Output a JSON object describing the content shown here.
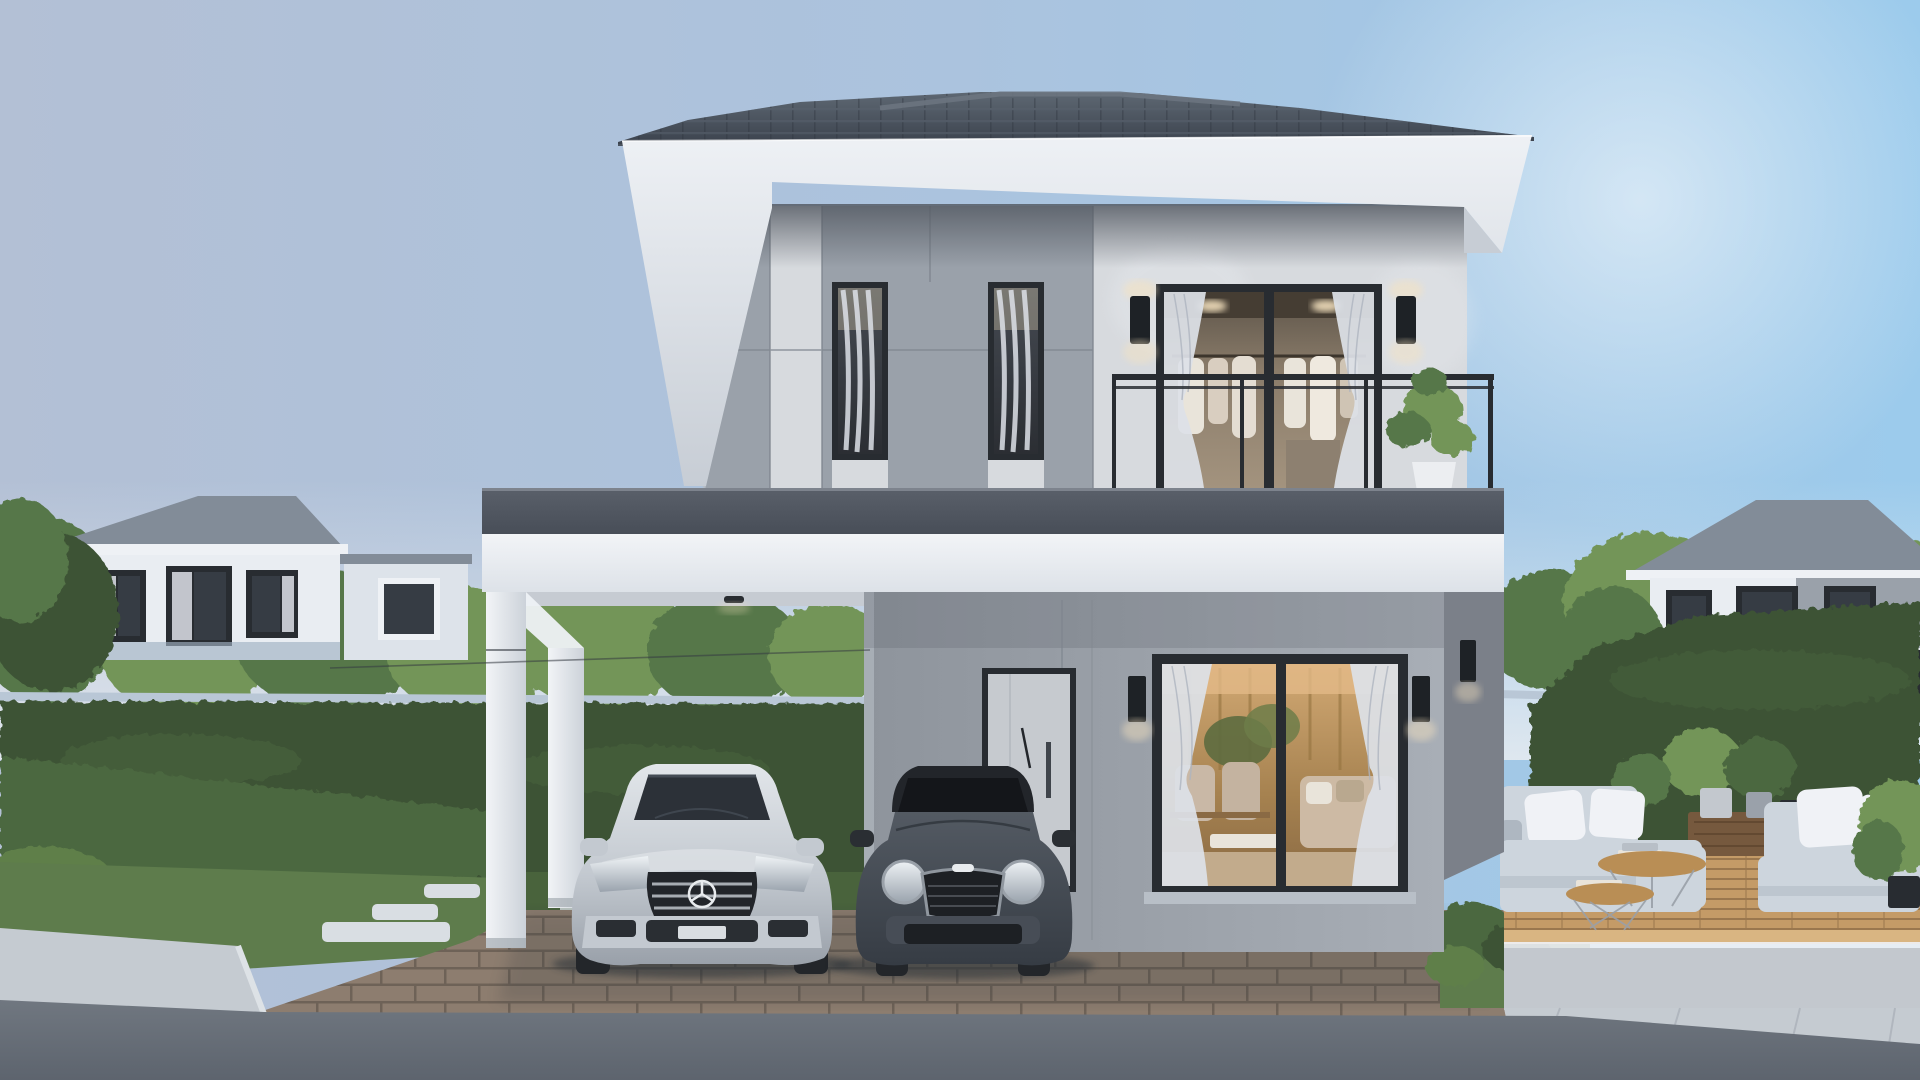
{
  "meta": {
    "type": "3d-architectural-rendering",
    "title": "Photorealistic exterior rendering of a modern two-storey grey house with carport, two parked cars, garden hedges, wooden patio deck and neighbouring houses at dusk",
    "time_of_day": "early evening, interior lights on",
    "visible_text": "none"
  },
  "palette": {
    "sky_left": "#b3c0d5",
    "sky_mid": "#abc3de",
    "sky_right": "#9ccbec",
    "sky_horizon": "#e9edf1",
    "roof_tile": "#3a414c",
    "roof_tile_lite": "#5e6873",
    "roof_ridge": "#6b7480",
    "fascia_white": "#eef1f5",
    "fascia_shade": "#c7cdd5",
    "soffit_dark": "#555b64",
    "band_dark": "#5a606a",
    "band_dark2": "#474d57",
    "slab_white": "#f2f4f7",
    "slab_shade": "#dde2e8",
    "wall_gray": "#9aa1aa",
    "wall_gray_dk": "#848b94",
    "wall_gray_lt": "#b8bfc7",
    "marble": "#d7dade",
    "marble_shade": "#b6bac2",
    "frame_dark": "#282c31",
    "curtain": "#dde1e7",
    "curtain_dk": "#aeb4bf",
    "interior_warm": "#b98f5e",
    "cloth_cream": "#e9e4da",
    "door_gray": "#c6cacf",
    "hedge_dark": "#3c5334",
    "hedge_mid": "#4c6840",
    "hedge_lite": "#5f7f4a",
    "grass": "#5e7c4c",
    "grass_dk": "#49633c",
    "tree": "#57774a",
    "tree_lite": "#739558",
    "wallcap": "#b9c7d6",
    "paver": "#8d7d6f",
    "paver_jt": "#6e6257",
    "street": "#707780",
    "street_dk": "#5d646e",
    "walk": "#c5cbd1",
    "walk_lt": "#d9dee3",
    "deck": "#c49b67",
    "deck_gap": "#9a774e",
    "deck_edge": "#d9b582",
    "concrete": "#c3c8ce",
    "sofa_out": "#cdd5dd",
    "sofa_out_dk": "#aeb7c1",
    "pillow": "#f0f2f6",
    "wood_dk": "#76593e",
    "wood_mid": "#b98e55",
    "car_silver": "#cdd2d8",
    "car_silver_dk": "#9aa1a9",
    "car_dark": "#474d56",
    "car_black": "#26292e",
    "chrome": "#e8ebee",
    "tire": "#23262a",
    "shadow": "#2c3238",
    "neigh_wall": "#e9edf2",
    "neigh_roof": "#828c98",
    "win_dark": "#363c44",
    "sconce": "#1e2226",
    "glow": "#f6e3c0"
  },
  "scene": {
    "main_house": {
      "storeys": 2,
      "roof": "dark grey hipped concrete-tile roof with white fascia",
      "second_floor": "grey panel facade (left) with two narrow curtained windows, white marble facade (right) with large walk-in-closet window, balcony railing and potted plant",
      "first_floor": "recessed porch with light grey front door, large sliding living-room window showing warm lit interior, black wall sconces",
      "carport": "flat white slab roof on square white columns, brick paver floor"
    },
    "vehicles": [
      {
        "name": "silver-mercedes-sedan",
        "position": "parked under carport, left"
      },
      {
        "name": "dark-grey-mini-cooper",
        "position": "parked under carport, right"
      }
    ],
    "landscape": {
      "left": "tall clipped hedge over low wall, lower hedge row, lawn with stepping stones, pale sidewalk and street",
      "right": "tall hedge, timber patio deck with two light-grey outdoor sofas, white cushions, round wooden coffee tables, potted plants",
      "background": "two neighbouring grey-roofed white houses among trees under a pale blue evening sky"
    }
  }
}
